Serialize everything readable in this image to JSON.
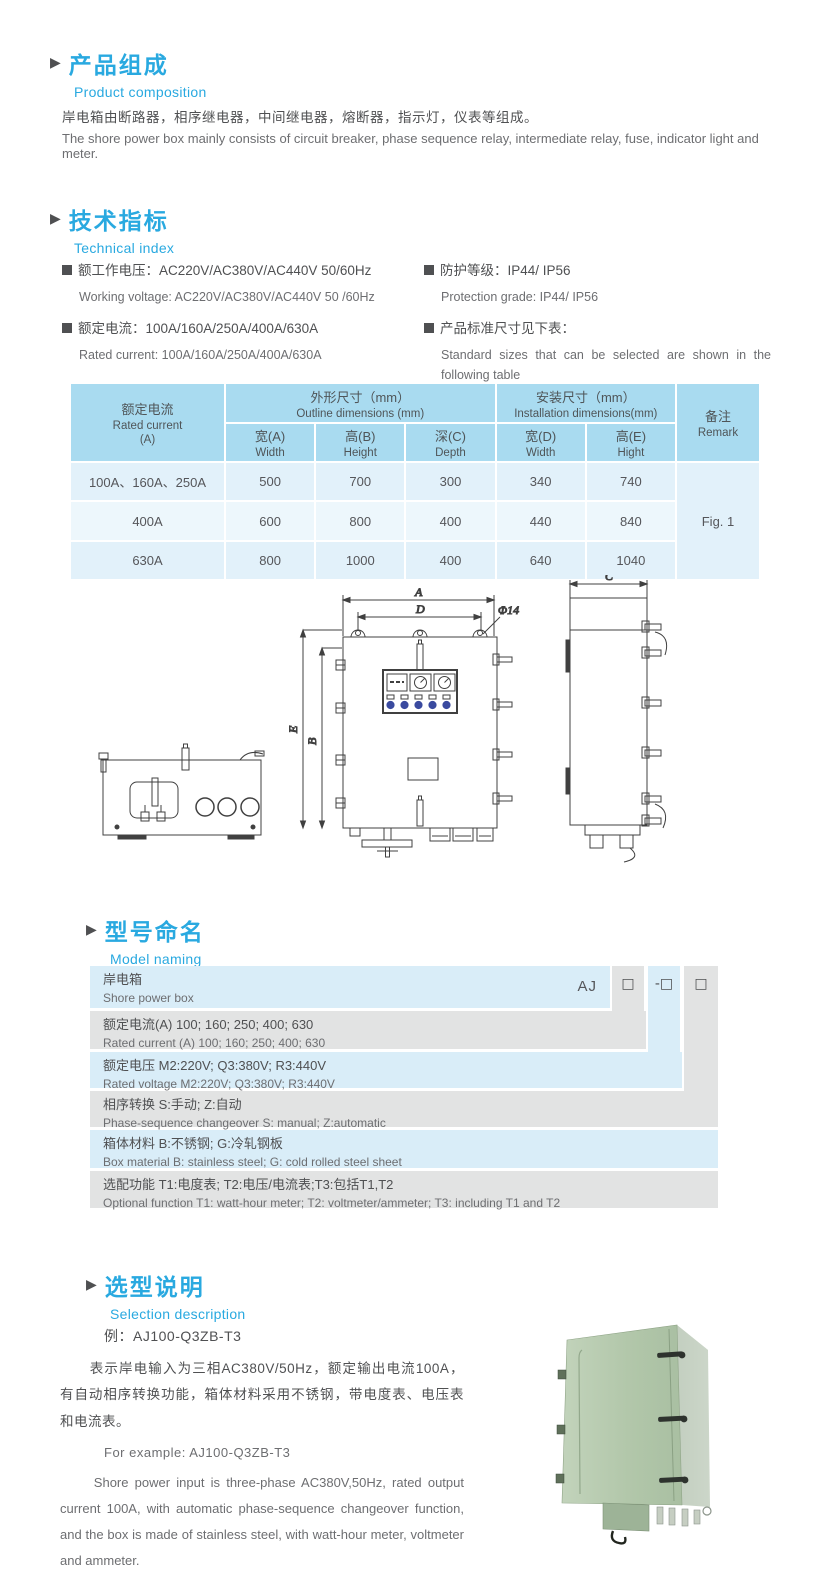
{
  "colors": {
    "accent": "#29a9e0",
    "text": "#58595b",
    "table_header_bg": "#a9dbf0",
    "table_row_bg": "#e2f1fa",
    "model_blue": "#d9edf8",
    "model_gray": "#e2e3e3",
    "photo_green": "#b5c8af"
  },
  "sections": {
    "composition": {
      "title_zh": "产品组成",
      "title_en": "Product  composition",
      "body_zh": "岸电箱由断路器，相序继电器，中间继电器，熔断器，指示灯，仪表等组成。",
      "body_en": "The shore power box mainly consists of circuit breaker, phase sequence relay, intermediate relay, fuse, indicator light and meter."
    },
    "technical": {
      "title_zh": "技术指标",
      "title_en": "Technical index",
      "specs": [
        {
          "zh": "额工作电压：AC220V/AC380V/AC440V  50/60Hz",
          "en": "Working voltage: AC220V/AC380V/AC440V 50 /60Hz"
        },
        {
          "zh": "额定电流：100A/160A/250A/400A/630A",
          "en": "Rated current: 100A/160A/250A/400A/630A"
        },
        {
          "zh": "防护等级：IP44/ IP56",
          "en": "Protection grade: IP44/ IP56"
        },
        {
          "zh": "产品标准尺寸见下表：",
          "en": "Standard sizes that can be selected are shown in the following table"
        }
      ]
    },
    "size_table": {
      "header": {
        "rated_current_zh": "额定电流",
        "rated_current_en": "Rated current",
        "rated_current_unit": "(A)",
        "outline_zh": "外形尺寸（mm）",
        "outline_en": "Outline dimensions (mm)",
        "install_zh": "安装尺寸（mm）",
        "install_en": "Installation dimensions(mm)",
        "remark_zh": "备注",
        "remark_en": "Remark",
        "sub": [
          {
            "zh": "宽(A)",
            "en": "Width"
          },
          {
            "zh": "高(B)",
            "en": "Height"
          },
          {
            "zh": "深(C)",
            "en": "Depth"
          },
          {
            "zh": "宽(D)",
            "en": "Width"
          },
          {
            "zh": "高(E)",
            "en": "Hight"
          }
        ]
      },
      "rows": [
        [
          "100A、160A、250A",
          "500",
          "700",
          "300",
          "340",
          "740"
        ],
        [
          "400A",
          "600",
          "800",
          "400",
          "440",
          "840"
        ],
        [
          "630A",
          "800",
          "1000",
          "400",
          "640",
          "1040"
        ]
      ],
      "remark_value": "Fig. 1"
    },
    "drawing": {
      "dim_a": "A",
      "dim_b": "B",
      "dim_c": "C",
      "dim_d": "D",
      "dim_e": "E",
      "hole": "Φ14"
    },
    "model": {
      "title_zh": "型号命名",
      "title_en": "Model naming",
      "prefix": "AJ",
      "boxes": [
        "□",
        "-□",
        "□"
      ],
      "rows": [
        {
          "zh": "岸电箱",
          "en": "Shore power box"
        },
        {
          "zh": "额定电流(A)  100; 160; 250; 400; 630",
          "en": "Rated current (A) 100; 160; 250; 400; 630"
        },
        {
          "zh": "额定电压   M2:220V;  Q3:380V;  R3:440V",
          "en": "Rated voltage   M2:220V;  Q3:380V;  R3:440V"
        },
        {
          "zh": "相序转换  S:手动; Z:自动",
          "en": "Phase-sequence changeover  S: manual;  Z:automatic"
        },
        {
          "zh": "箱体材料     B:不锈钢;  G:冷轧钢板",
          "en": "Box material    B: stainless steel; G: cold rolled steel sheet"
        },
        {
          "zh": "选配功能       T1:电度表;  T2:电压/电流表;T3:包括T1,T2",
          "en": "Optional function   T1: watt-hour meter; T2: voltmeter/ammeter; T3: including T1 and T2"
        }
      ]
    },
    "selection": {
      "title_zh": "选型说明",
      "title_en": "Selection description",
      "example_zh": "例：AJ100-Q3ZB-T3",
      "body_zh": "表示岸电输入为三相AC380V/50Hz，额定输出电流100A，有自动相序转换功能，箱体材料采用不锈钢，带电度表、电压表和电流表。",
      "example_en": "For example: AJ100-Q3ZB-T3",
      "body_en": "Shore power input is three-phase AC380V,50Hz, rated output current 100A, with automatic phase-sequence changeover function, and the box is made of stainless steel, with watt-hour meter, voltmeter and ammeter."
    }
  }
}
